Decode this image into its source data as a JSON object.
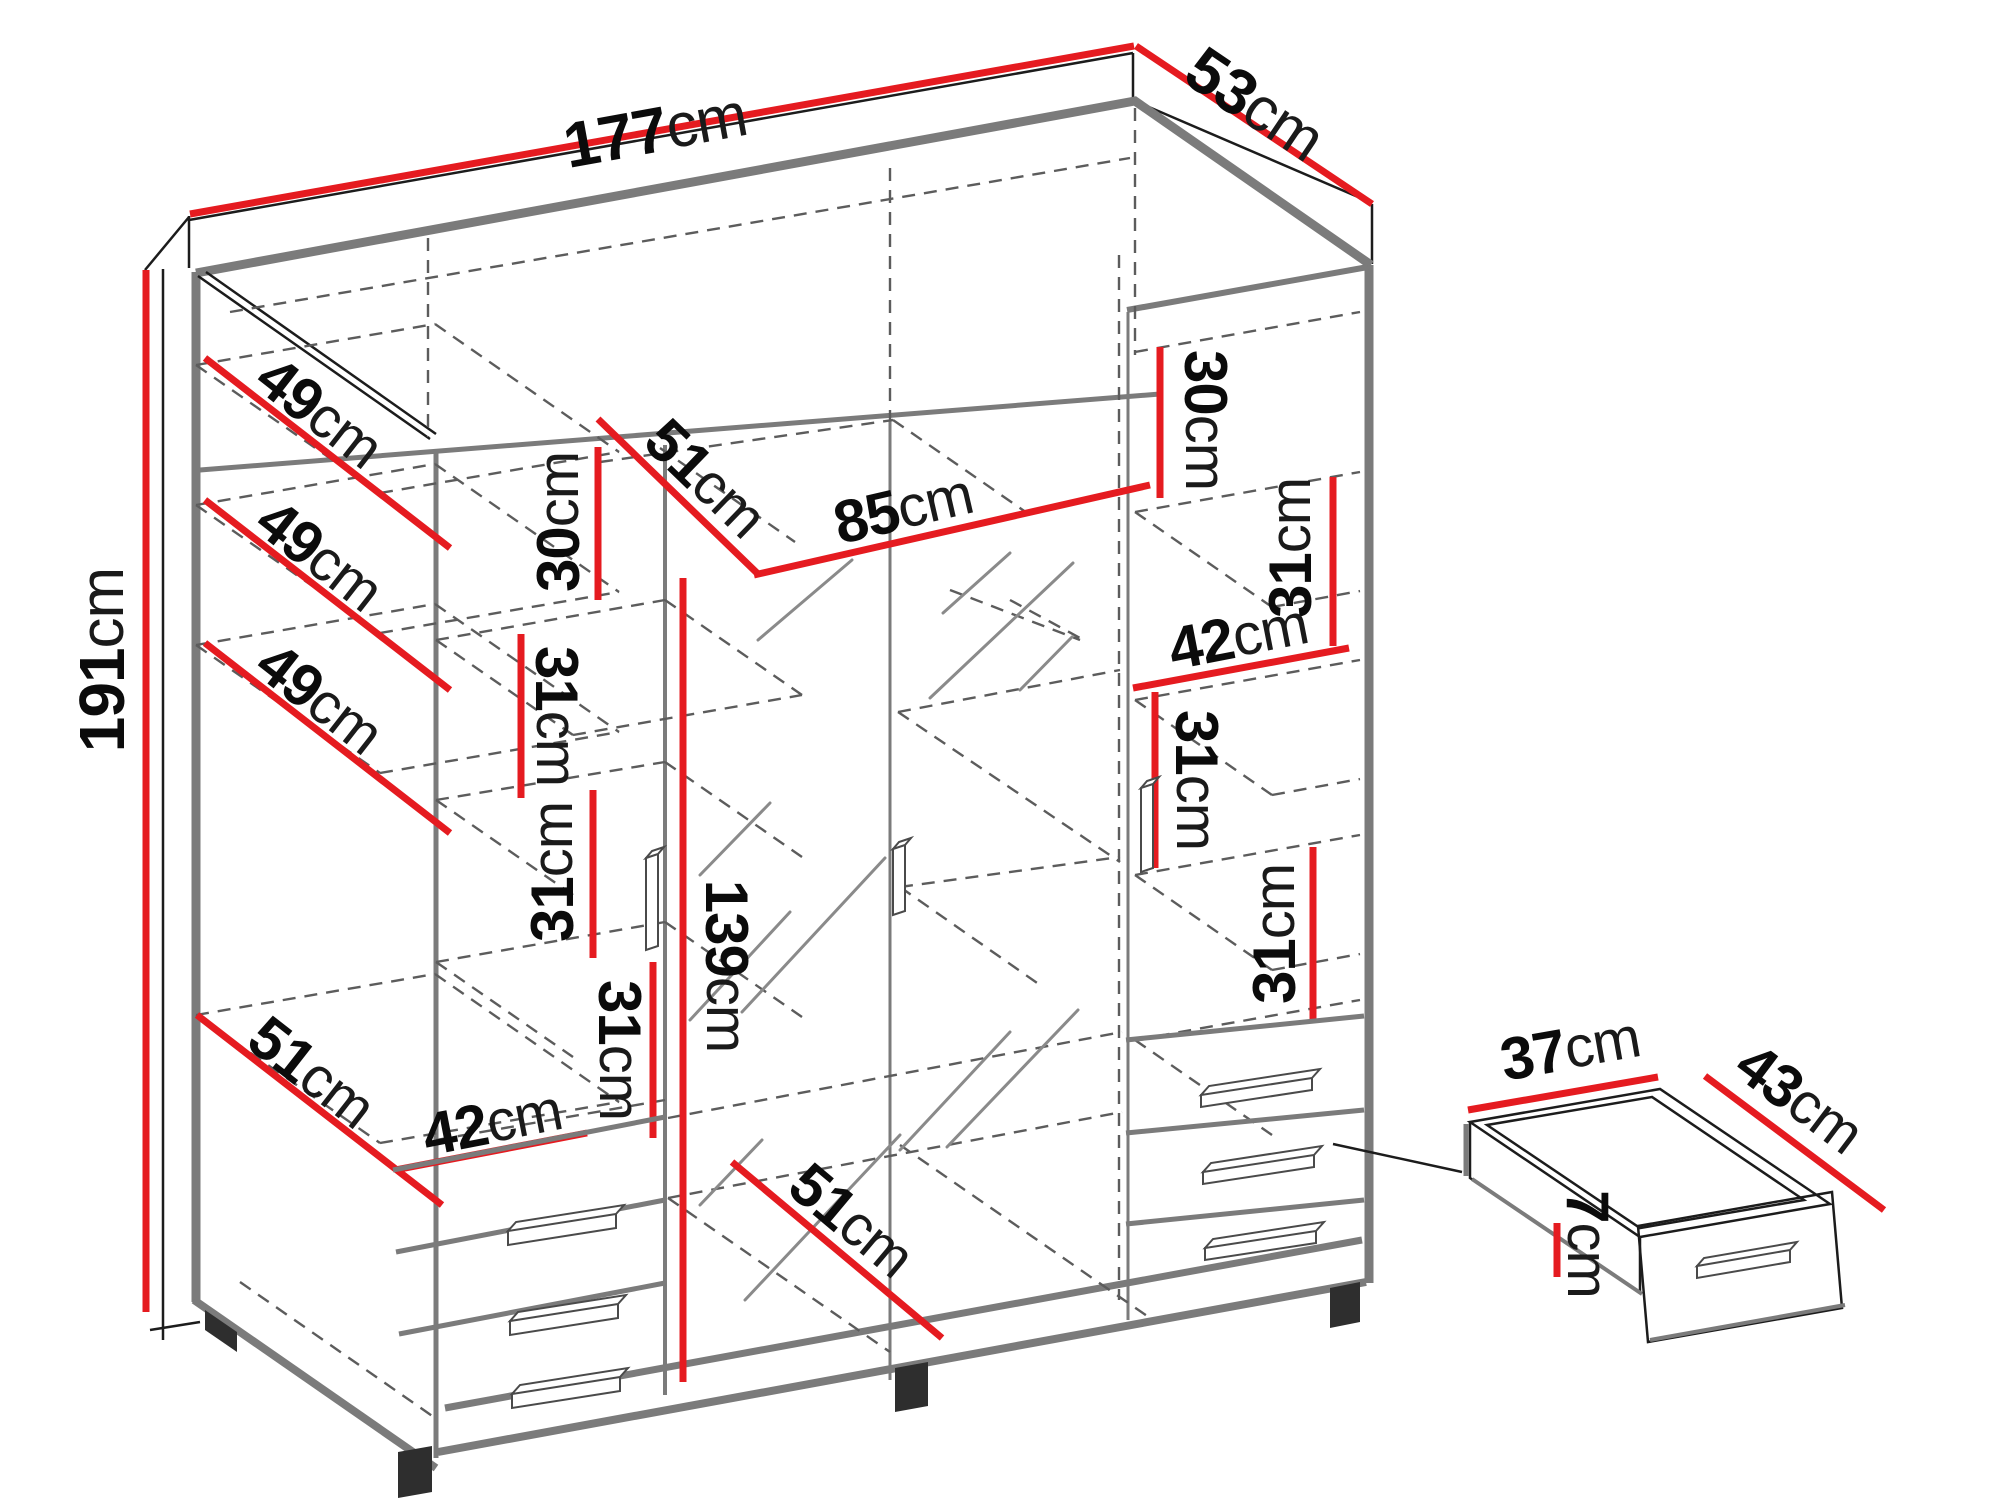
{
  "diagram_type": "furniture-dimension-diagram",
  "unit": "cm",
  "colors": {
    "dimension_red": "#e51b20",
    "carcass_gray": "#7b7b7b",
    "hidden_line_gray": "#5c5c5c",
    "text_black": "#0b0b0b",
    "background": "#ffffff"
  },
  "dimensions": {
    "width_total": {
      "value": "177",
      "unit": "cm"
    },
    "depth_total": {
      "value": "53",
      "unit": "cm"
    },
    "height_total": {
      "value": "191",
      "unit": "cm"
    },
    "left_shelf_1": {
      "value": "49",
      "unit": "cm"
    },
    "left_shelf_2": {
      "value": "49",
      "unit": "cm"
    },
    "left_shelf_3": {
      "value": "49",
      "unit": "cm"
    },
    "left_shelf_4": {
      "value": "51",
      "unit": "cm"
    },
    "center_top_height": {
      "value": "30",
      "unit": "cm"
    },
    "center_top_depth": {
      "value": "51",
      "unit": "cm"
    },
    "hanging_width": {
      "value": "85",
      "unit": "cm"
    },
    "center_gap_1": {
      "value": "31",
      "unit": "cm"
    },
    "center_gap_2": {
      "value": "31",
      "unit": "cm"
    },
    "center_gap_3": {
      "value": "31",
      "unit": "cm"
    },
    "left_drawer_width": {
      "value": "42",
      "unit": "cm"
    },
    "hanging_height": {
      "value": "139",
      "unit": "cm"
    },
    "bottom_depth": {
      "value": "51",
      "unit": "cm"
    },
    "right_top_height": {
      "value": "30",
      "unit": "cm"
    },
    "right_gap_1": {
      "value": "31",
      "unit": "cm"
    },
    "right_shelf_width": {
      "value": "42",
      "unit": "cm"
    },
    "right_gap_2": {
      "value": "31",
      "unit": "cm"
    },
    "right_gap_3": {
      "value": "31",
      "unit": "cm"
    },
    "drawer_width": {
      "value": "37",
      "unit": "cm"
    },
    "drawer_depth": {
      "value": "43",
      "unit": "cm"
    },
    "drawer_height": {
      "value": "7",
      "unit": "cm"
    }
  }
}
